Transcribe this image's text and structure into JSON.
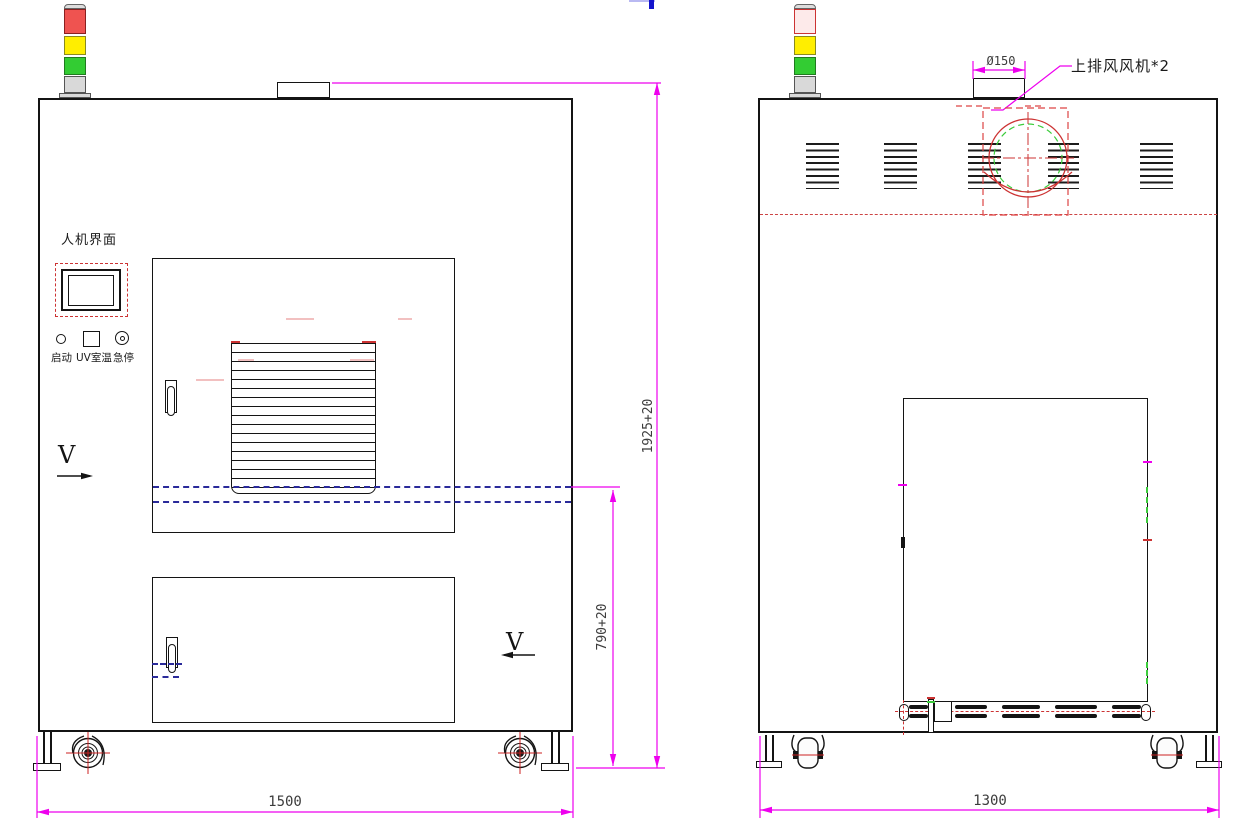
{
  "front_view": {
    "hmi_label": "人机界面",
    "btn_start": "启动",
    "btn_uv_temp": "UV室温",
    "btn_estop": "急停",
    "section_v_left": "V",
    "section_v_right": "V",
    "dim_width": "1500",
    "dim_height": "1925+20",
    "dim_level": "790+20"
  },
  "back_view": {
    "dim_duct_diameter": "Ø150",
    "fan_callout": "上排风风机*2",
    "dim_width": "1300"
  },
  "colors": {
    "dimension": "#ee00ee",
    "hidden_red": "#cc3333",
    "center_blue": "#2a2a9a",
    "fan_green": "#3ccc3c",
    "tower_red": "#ef5350",
    "tower_yellow": "#ffee00",
    "tower_green": "#33cc33"
  }
}
